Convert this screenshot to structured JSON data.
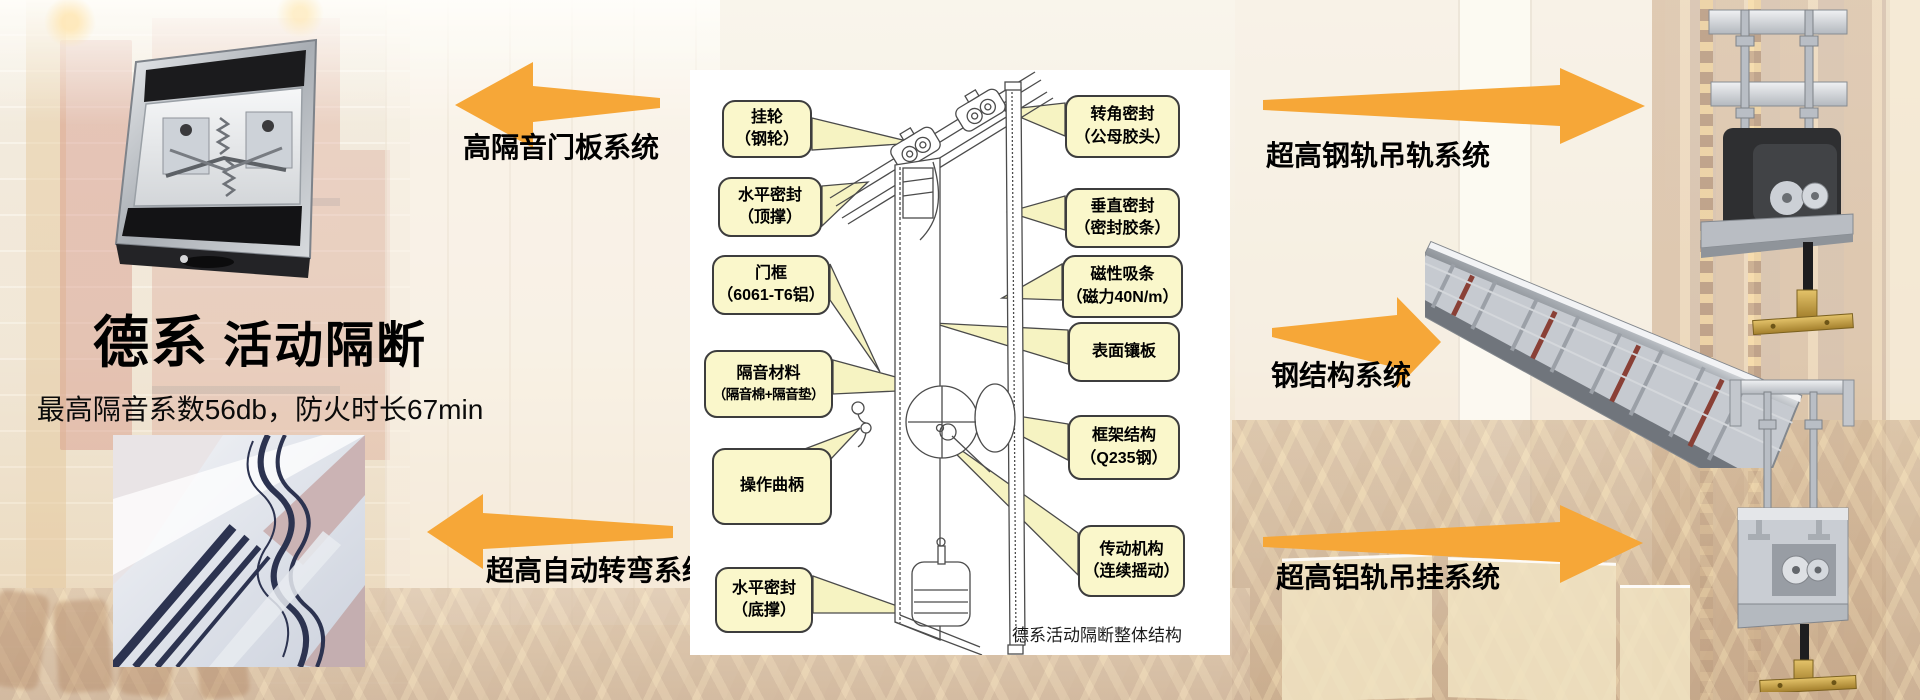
{
  "colors": {
    "arrow_orange": "#F6A738",
    "callout_fill": "#FAF7CB",
    "callout_border": "#3D3D3D",
    "panel_background": "#FFFFFF",
    "label_text": "#000000"
  },
  "hero": {
    "title_strong": "德系",
    "title_rest": "活动隔断",
    "subtitle": "最高隔音系数56db，防火时长67min"
  },
  "system_labels": {
    "top_left": "高隔音门板系统",
    "bottom_left": "超高自动转弯系统",
    "top_right": "超高钢轨吊轨系统",
    "middle_right": "钢结构系统",
    "bottom_right": "超高铝轨吊挂系统"
  },
  "diagram": {
    "caption": "德系活动隔断整体结构",
    "left_callouts": [
      {
        "line1": "挂轮",
        "line2": "（钢轮）"
      },
      {
        "line1": "水平密封",
        "line2": "（顶撑）"
      },
      {
        "line1": "门框",
        "line2": "（6061-T6铝）"
      },
      {
        "line1": "隔音材料",
        "line2": "（隔音棉+隔音垫）"
      },
      {
        "line1": "操作曲柄",
        "line2": ""
      },
      {
        "line1": "水平密封",
        "line2": "（底撑）"
      }
    ],
    "right_callouts": [
      {
        "line1": "转角密封",
        "line2": "（公母胶头）"
      },
      {
        "line1": "垂直密封",
        "line2": "（密封胶条）"
      },
      {
        "line1": "磁性吸条",
        "line2": "（磁力40N/m）"
      },
      {
        "line1": "表面镶板",
        "line2": ""
      },
      {
        "line1": "框架结构",
        "line2": "（Q235钢）"
      },
      {
        "line1": "传动机构",
        "line2": "（连续摇动）"
      }
    ]
  }
}
